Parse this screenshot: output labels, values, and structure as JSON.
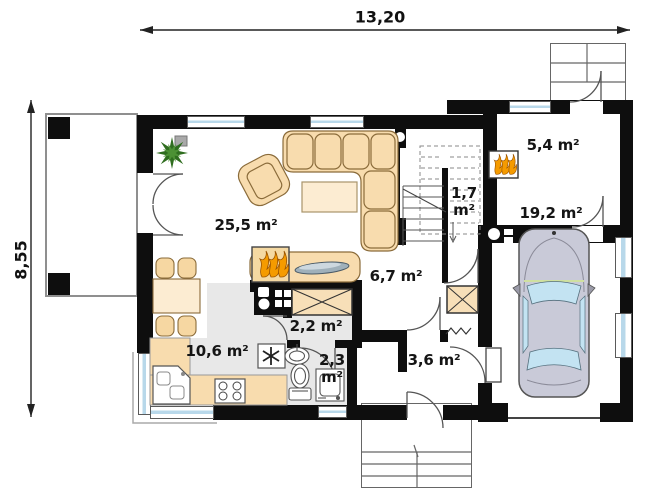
{
  "title": "single-family house ground floor plan",
  "dimensions": {
    "width": "13,20",
    "height": "8,55"
  },
  "rooms": {
    "living": {
      "name": "living-dining-room",
      "area": "25,5 m²"
    },
    "kitchen": {
      "name": "kitchen",
      "area": "10,6 m²"
    },
    "hall": {
      "name": "hall",
      "area": "6,7 m²"
    },
    "stairs": {
      "name": "staircase",
      "area": "1,7",
      "area_unit": "m²"
    },
    "boiler": {
      "name": "boiler-room",
      "area": "5,4 m²"
    },
    "garage": {
      "name": "garage",
      "area": "19,2 m²"
    },
    "pantry": {
      "name": "pantry-corridor",
      "area": "2,2 m²"
    },
    "wc": {
      "name": "wc",
      "area": "2,3",
      "area_unit": "m²"
    },
    "entry": {
      "name": "entry-vestibule",
      "area": "3,6 m²"
    }
  },
  "icons": {
    "fireplace": "flames",
    "boiler_stove": "flames",
    "fridge": "snowflake-asterisk",
    "radiator": "zigzag",
    "chimney": "white-flue-circle",
    "plant": "potted-plant",
    "car": "car-top-view"
  },
  "colors": {
    "wall": "#0e0e0e",
    "floor": "#e8e8e8",
    "furniture": "#f8dcae",
    "furnitureLight": "#fcecd2",
    "glass": "#b8d8ea",
    "flame": "#f59b00",
    "flameDark": "#9c5400",
    "carBody": "#c9cad8",
    "carGlass": "#c3e3f2",
    "plant": "#2f6d1f",
    "text": "#151515",
    "line": "#555555"
  }
}
